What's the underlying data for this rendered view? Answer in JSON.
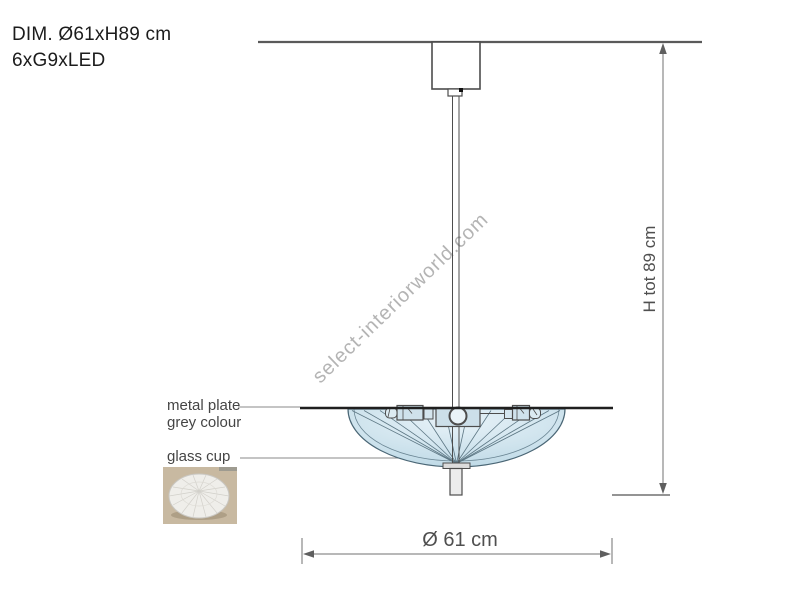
{
  "header": {
    "line1": "DIM. Ø61xH89 cm",
    "line2": "6xG9xLED"
  },
  "labels": {
    "metal_plate_line1": "metal plate",
    "metal_plate_line2": "grey colour",
    "glass_cup": "glass cup"
  },
  "dimensions": {
    "total_height": "H tot 89 cm",
    "diameter": "Ø 61 cm"
  },
  "watermark": {
    "text": "select-interiorworld.com",
    "color": "#b4b4b4"
  },
  "colors": {
    "outline": "#4d4d4d",
    "dimension_line": "#707070",
    "plate_line": "#1f1f1f",
    "glass_center": "#e7f2f8",
    "glass_edge": "#bcd8e5",
    "rib_line": "#5d7784",
    "thumbnail_background": "#c8b9a1",
    "label_text": "#454545"
  }
}
